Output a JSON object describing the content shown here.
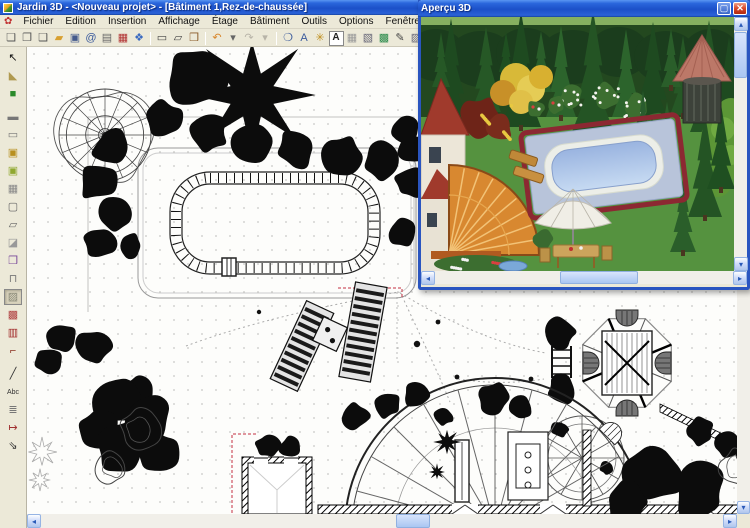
{
  "window": {
    "title": "Jardin 3D - <Nouveau projet> - [Bâtiment 1,Rez-de-chaussée]"
  },
  "menu": {
    "icon_glyph": "✿",
    "items": [
      "Fichier",
      "Edition",
      "Insertion",
      "Affichage",
      "Étage",
      "Bâtiment",
      "Outils",
      "Options",
      "Fenêtre",
      "Outils avancés"
    ]
  },
  "toolbar": {
    "items": [
      {
        "name": "new-project-icon",
        "glyph": "❏",
        "color": "#555"
      },
      {
        "name": "open-project-icon",
        "glyph": "❐",
        "color": "#555"
      },
      {
        "name": "page-setup-icon",
        "glyph": "❑",
        "color": "#555"
      },
      {
        "name": "open-folder-icon",
        "glyph": "▰",
        "color": "#d8a030"
      },
      {
        "name": "save-icon",
        "glyph": "▣",
        "color": "#445a8c"
      },
      {
        "name": "send-mail-icon",
        "glyph": "@",
        "color": "#3a5a9c"
      },
      {
        "name": "print-icon",
        "glyph": "▤",
        "color": "#666"
      },
      {
        "name": "export-image-icon",
        "glyph": "▦",
        "color": "#b03030"
      },
      {
        "name": "export-3d-icon",
        "glyph": "❖",
        "color": "#3a6ac0"
      },
      {
        "sep": true
      },
      {
        "name": "draw-room-icon",
        "glyph": "▭",
        "color": "#444"
      },
      {
        "name": "draw-polygon-room-icon",
        "glyph": "▱",
        "color": "#444"
      },
      {
        "name": "object-catalog-icon",
        "glyph": "❒",
        "color": "#8a5a28"
      },
      {
        "sep": true
      },
      {
        "name": "undo-icon",
        "glyph": "↶",
        "color": "#d8862a"
      },
      {
        "name": "undo-list-icon",
        "glyph": "▾",
        "color": "#666"
      },
      {
        "name": "redo-icon",
        "glyph": "↷",
        "color": "#b8b4a8"
      },
      {
        "name": "redo-list-icon",
        "glyph": "▾",
        "color": "#b8b4a8"
      },
      {
        "sep": true
      },
      {
        "name": "zoom-icon",
        "glyph": "❍",
        "color": "#3a5a9c"
      },
      {
        "name": "zoom-text-icon",
        "glyph": "A",
        "color": "#3a5a9c"
      },
      {
        "name": "render-options-icon",
        "glyph": "✳",
        "color": "#c09020"
      },
      {
        "name": "text-format-icon",
        "glyph": "A",
        "color": "#222",
        "boxed": true
      },
      {
        "name": "grid-display-icon",
        "glyph": "▦",
        "color": "#999"
      },
      {
        "name": "wall-display-icon",
        "glyph": "▧",
        "color": "#667"
      },
      {
        "name": "texture-display-icon",
        "glyph": "▩",
        "color": "#2a8a4a"
      },
      {
        "name": "annotation-pen-icon",
        "glyph": "✎",
        "color": "#444"
      },
      {
        "name": "hatch-display-icon",
        "glyph": "▨",
        "color": "#667"
      }
    ]
  },
  "sidebar": {
    "tools": [
      {
        "name": "select-tool-icon",
        "glyph": "↖",
        "color": "#111"
      },
      {
        "name": "measure-tool-icon",
        "glyph": "◣",
        "color": "#b09a50"
      },
      {
        "name": "terrain-tool-icon",
        "glyph": "■",
        "color": "#2a8a2a",
        "gap": true
      },
      {
        "name": "wall-tool-icon",
        "glyph": "▬",
        "color": "#777"
      },
      {
        "name": "wall-edit-tool-icon",
        "glyph": "▭",
        "color": "#777"
      },
      {
        "name": "window-tool-icon",
        "glyph": "▣",
        "color": "#b89020"
      },
      {
        "name": "surface-tool-icon",
        "glyph": "▣",
        "color": "#90a830"
      },
      {
        "name": "paving-tool-icon",
        "glyph": "▦",
        "color": "#888"
      },
      {
        "name": "outline-tool-icon",
        "glyph": "▢",
        "color": "#666"
      },
      {
        "name": "polygon-tool-icon",
        "glyph": "▱",
        "color": "#666"
      },
      {
        "name": "ramp-tool-icon",
        "glyph": "◪",
        "color": "#999"
      },
      {
        "name": "slab-tool-icon",
        "glyph": "❒",
        "color": "#7a4a9a"
      },
      {
        "name": "column-tool-icon",
        "glyph": "⊓",
        "color": "#777"
      },
      {
        "name": "floor-tool-icon",
        "glyph": "▨",
        "color": "#887",
        "active": true
      },
      {
        "name": "roof-tool-icon",
        "glyph": "▩",
        "color": "#b04040"
      },
      {
        "name": "furniture-tool-icon",
        "glyph": "▥",
        "color": "#a02828"
      },
      {
        "name": "door-tool-icon",
        "glyph": "⌐",
        "color": "#8a3020",
        "gap": true
      },
      {
        "name": "line-tool-icon",
        "glyph": "╱",
        "color": "#333"
      },
      {
        "name": "text-tool-icon",
        "glyph": "Abc",
        "color": "#333"
      },
      {
        "name": "stairs-tool-icon",
        "glyph": "≣",
        "color": "#777"
      },
      {
        "name": "dimension-tool-icon",
        "glyph": "↦",
        "color": "#a03030"
      },
      {
        "name": "camera-tool-icon",
        "glyph": "⇘",
        "color": "#333"
      }
    ]
  },
  "preview": {
    "title": "Aperçu 3D",
    "maximize_glyph": "▢",
    "close_glyph": "✕"
  },
  "icons": {
    "scroll_left": "◂",
    "scroll_right": "▸",
    "scroll_up": "▴",
    "scroll_down": "▾"
  }
}
